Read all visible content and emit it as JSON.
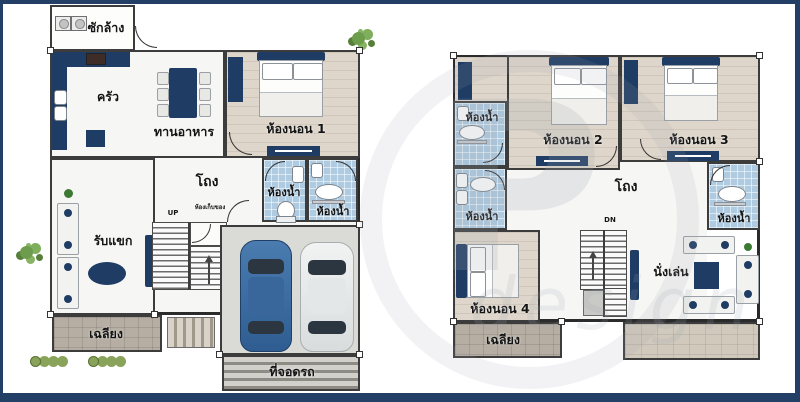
{
  "watermark": {
    "letter": "P",
    "word": "design"
  },
  "colors": {
    "navy_furniture": "#1e3c64",
    "frame_border": "#233f66",
    "bath_tile_blue": "#aecbe2",
    "wood_floor": "#ded6ca",
    "porch_gray": "#b6aea3",
    "terrace_tan": "#d0c9bc",
    "garage_gray": "#dadad6",
    "wall_line": "#3c3c3c",
    "car_blue": "#3f6fa3",
    "car_white": "#eef0f0",
    "tree_green": "#6d9c4c"
  },
  "floor1": {
    "labels": {
      "laundry": "ซักล้าง",
      "kitchen": "ครัว",
      "dining": "ทานอาหาร",
      "bedroom1": "ห้องนอน 1",
      "hall": "โถง",
      "bath1": "ห้องน้ำ",
      "bath2": "ห้องน้ำ",
      "living": "รับแขก",
      "storage": "ห้องเก็บของ",
      "stairs_up": "UP",
      "porch": "เฉลียง",
      "carpark": "ที่จอดรถ"
    }
  },
  "floor2": {
    "labels": {
      "bath_top": "ห้องน้ำ",
      "bath_mid": "ห้องน้ำ",
      "bedroom2": "ห้องนอน 2",
      "bedroom3": "ห้องนอน 3",
      "hall": "โถง",
      "bath_right": "ห้องน้ำ",
      "bedroom4": "ห้องนอน 4",
      "stairs_dn": "DN",
      "sitting": "นั่งเล่น",
      "balcony": "เฉลียง"
    }
  }
}
